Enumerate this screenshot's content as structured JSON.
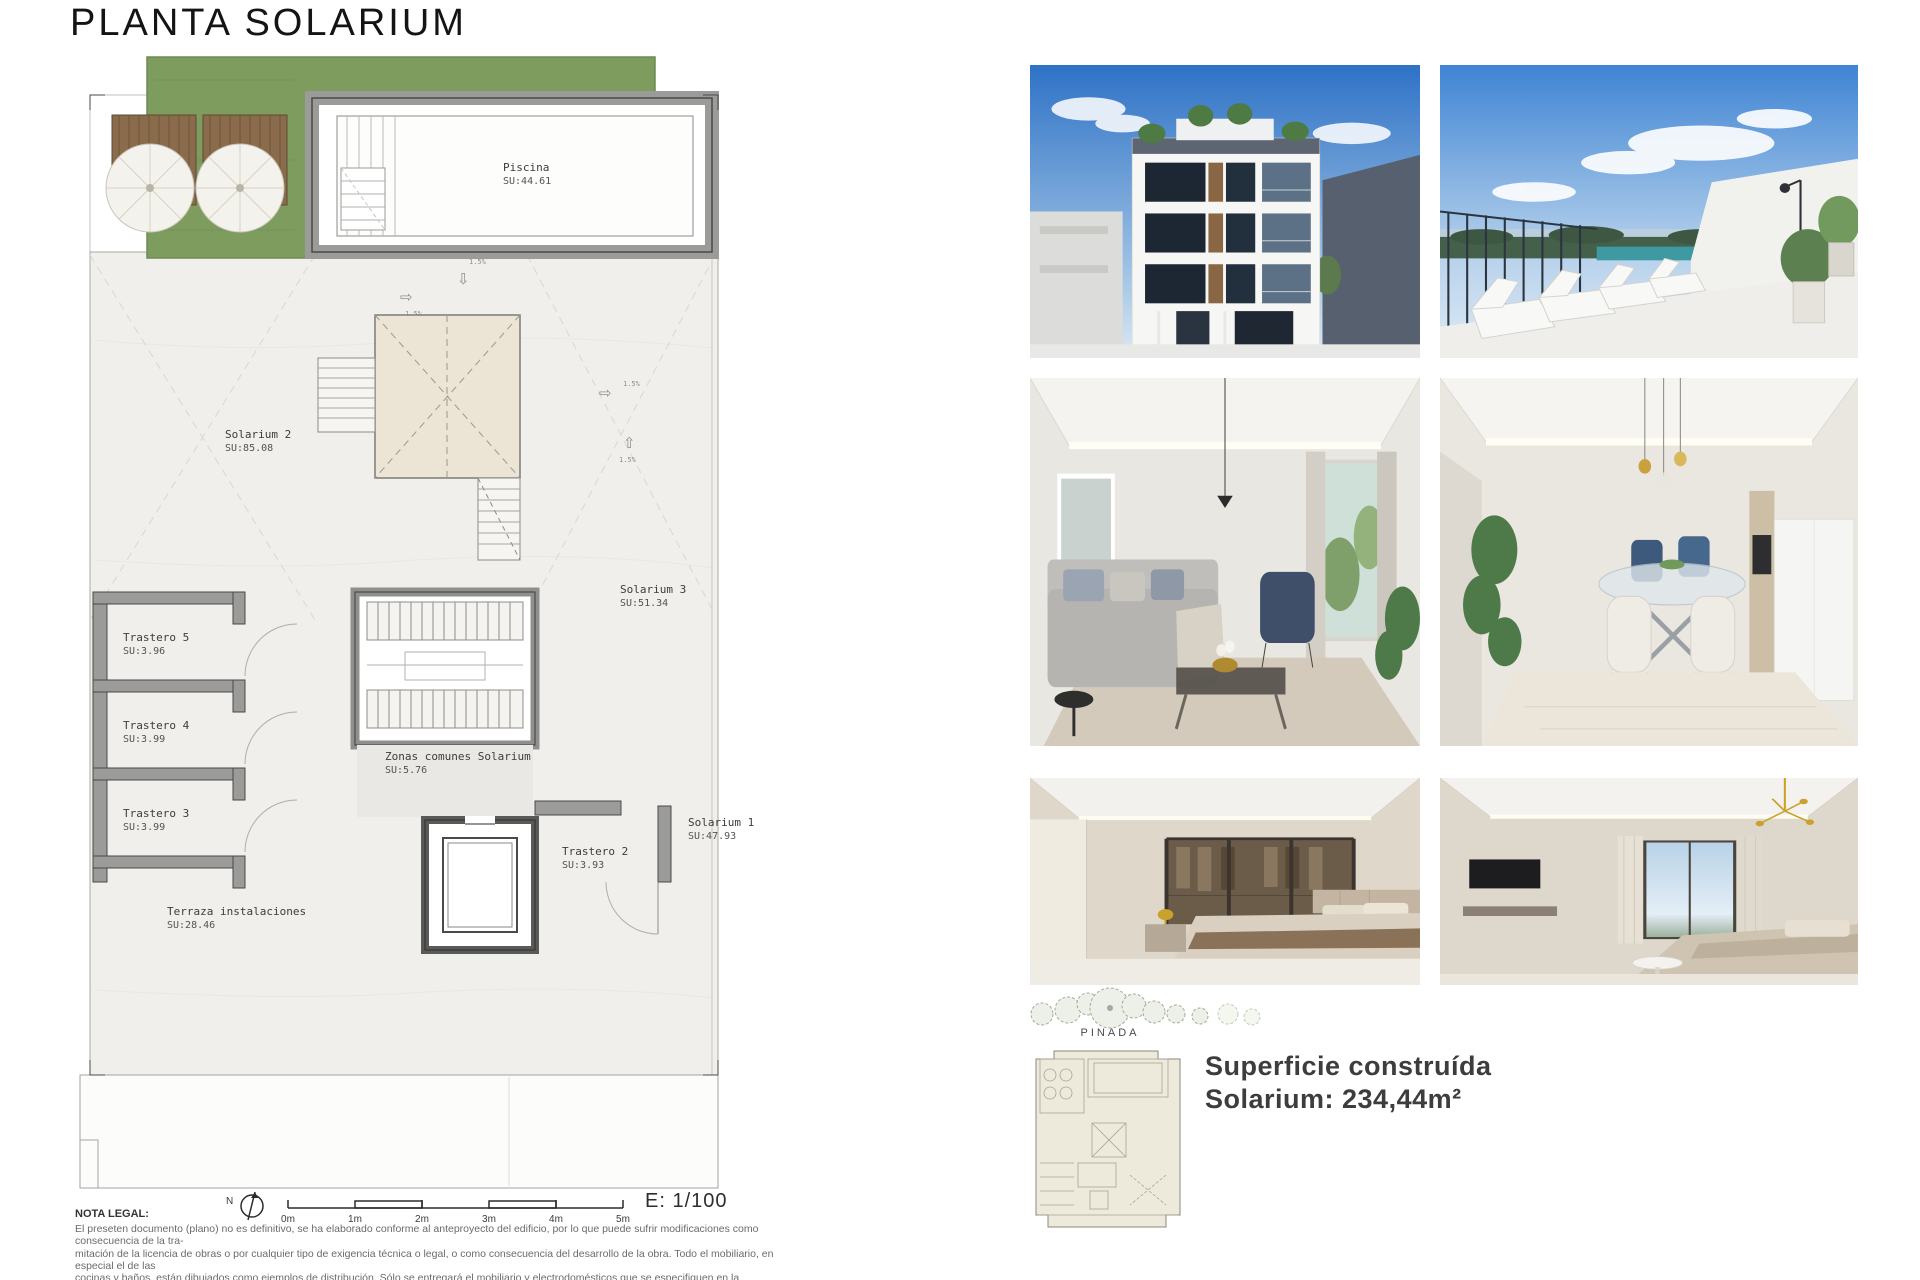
{
  "title": "PLANTA SOLARIUM",
  "plan": {
    "rooms": [
      {
        "name": "Piscina",
        "area": "SU:44.61"
      },
      {
        "name": "Solarium 2",
        "area": "SU:85.08"
      },
      {
        "name": "Solarium 3",
        "area": "SU:51.34"
      },
      {
        "name": "Solarium 1",
        "area": "SU:47.93"
      },
      {
        "name": "Trastero 5",
        "area": "SU:3.96"
      },
      {
        "name": "Trastero 4",
        "area": "SU:3.99"
      },
      {
        "name": "Trastero 3",
        "area": "SU:3.99"
      },
      {
        "name": "Trastero 2",
        "area": "SU:3.93"
      },
      {
        "name": "Zonas comunes Solarium",
        "area": "SU:5.76"
      },
      {
        "name": "Terraza instalaciones",
        "area": "SU:28.46"
      }
    ],
    "slope_label": "1.5%",
    "arrows": {
      "down": "⇩",
      "right": "⇨",
      "up": "⇧"
    },
    "north_label": "N",
    "scale": {
      "ticks": [
        "0m",
        "1m",
        "2m",
        "3m",
        "4m",
        "5m"
      ],
      "ratio": "E: 1/100"
    }
  },
  "gallery": {
    "photos": [
      {
        "id": "building-facade"
      },
      {
        "id": "rooftop-solarium"
      },
      {
        "id": "living-room"
      },
      {
        "id": "dining-kitchen"
      },
      {
        "id": "bedroom-dressing"
      },
      {
        "id": "bedroom-window"
      }
    ]
  },
  "site": {
    "label": "PINADA"
  },
  "summary": {
    "line1": "Superficie construída",
    "line2": "Solarium: 234,44m²"
  },
  "legal": {
    "heading": "NOTA LEGAL:",
    "lines": [
      "El preseten documento (plano) no es definitivo, se ha elaborado conforme al anteproyecto del edificio, por lo que puede sufrir modificaciones como consecuencia de la tra-",
      "mitación de la licencia de obras o por cualquier tipo de exigencia técnica o legal, o como consecuencia del desarrollo de la obra. Todo el mobiliario, en especial el de las",
      "cocinas y baños, están dibujados como ejemplos de distribución. Sólo se entregará el mobiliario y electrodomésticos que se especifiquen en la memoria comercial definitiva.",
      "Es un plano meramente informativo, sin contenido contractual."
    ]
  },
  "colors": {
    "grass_green": "#7d9c5e",
    "wall_gray": "#9b9b99",
    "sky_blue": "#3f84d4"
  }
}
